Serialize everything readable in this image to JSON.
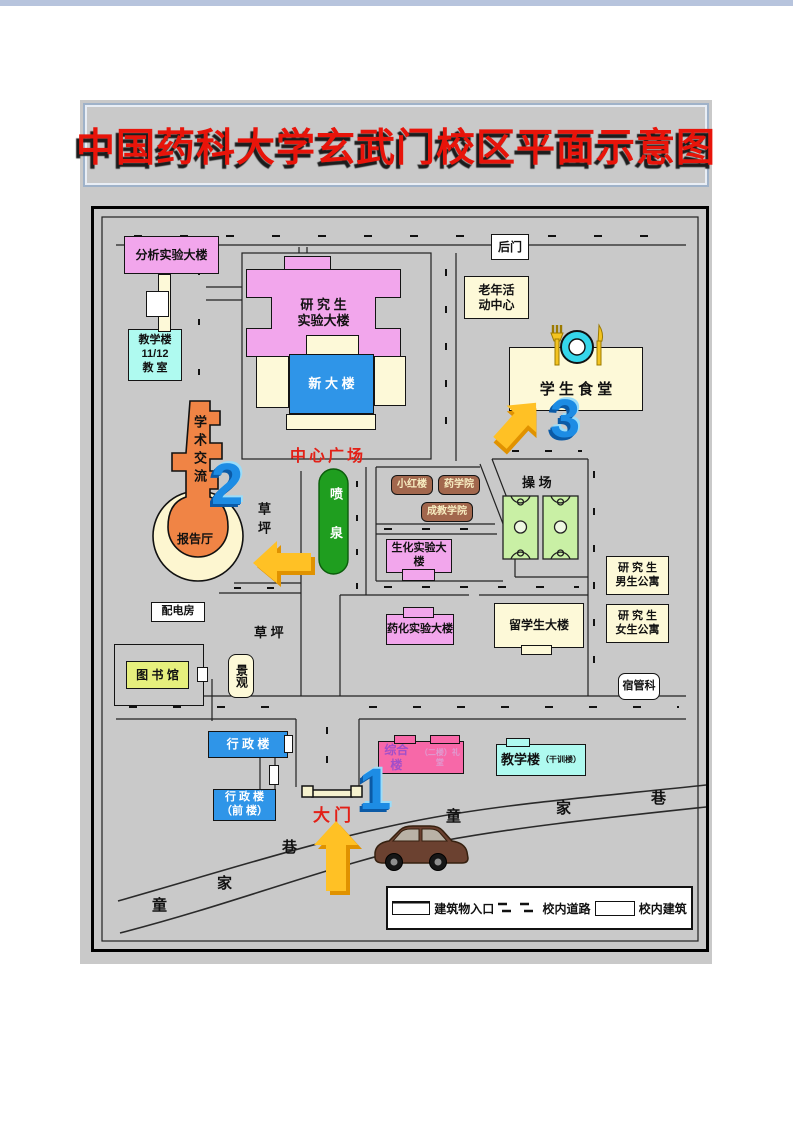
{
  "page": {
    "title": "中国药科大学玄武门校区平面示意图"
  },
  "colors": {
    "banner_red": "#e8140a",
    "map_bg": "#c9c9c9",
    "pink_lab": "#f2a6ec",
    "blue_bldg": "#2f95e8",
    "cyan_bldg": "#affaf0",
    "cream_bldg": "#fdf9d8",
    "orange_hall": "#f08445",
    "fountain_green": "#1f9e1f",
    "court_green": "#c9f0a5",
    "brown_bldg": "#a2674d",
    "library_yellow": "#e6ef7d",
    "magenta_bldg": "#f768a8",
    "arrow_yellow": "#ffc125",
    "number_blue": "#1d8ce4"
  },
  "buildings": {
    "fenxi": "分析实验大楼",
    "jxl1112_l1": "教学楼",
    "jxl1112_l2": "11/12",
    "jxl1112_l3": "教 室",
    "yjs_l1": "研 究 生",
    "yjs_l2": "实验大楼",
    "xindalou": "新 大 楼",
    "houmen": "后门",
    "laonian_l1": "老年活",
    "laonian_l2": "动中心",
    "shitang": "学 生 食 堂",
    "xueshu": "学术交流",
    "baogaoting": "报告厅",
    "caoping_v": "草坪",
    "caoping_h": "草  坪",
    "zhongxin": "中心广场",
    "penquan": "喷泉",
    "xiaohonglou": "小红楼",
    "yaoxueyuan": "药学院",
    "chengjiao": "成教学院",
    "shenghua": "生化实验大楼",
    "caochang": "操    场",
    "nan_l1": "研 究 生",
    "nan_l2": "男生公寓",
    "nv_l1": "研 究 生",
    "nv_l2": "女生公寓",
    "peidianfang": "配电房",
    "tushuguan": "图 书 馆",
    "jingguan": "景观",
    "yaohua": "药化实验大楼",
    "liuxuesheng": "留学生大楼",
    "suguanke": "宿管科",
    "xingzheng": "行 政 楼",
    "xingzhengq_l1": "行 政 楼",
    "xingzhengq_l2": "（前  楼）",
    "damen": "大门",
    "zonghe": "综合楼",
    "zonghe_sub": "（二楼）礼堂",
    "jiaoxuelou": "教学楼",
    "jiaoxuelou_sub": "（干训楼）"
  },
  "markers": {
    "n1": "1",
    "n2": "2",
    "n3": "3"
  },
  "street": {
    "left": [
      "童",
      "家",
      "巷"
    ],
    "right": [
      "童",
      "家",
      "巷"
    ]
  },
  "legend": {
    "entrance": "建筑物入口",
    "road": "校内道路",
    "building": "校内建筑"
  }
}
